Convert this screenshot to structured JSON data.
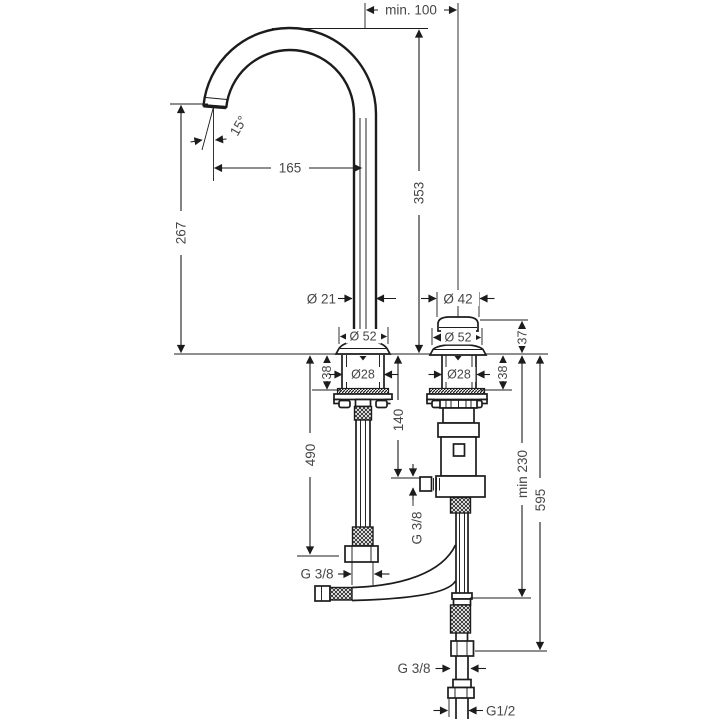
{
  "drawing": {
    "kind": "technical-installation-diagram",
    "subject": "two-hole basin mixer with gooseneck spout and below-deck valve",
    "colors": {
      "line": "#1c1c1c",
      "label": "#474747",
      "background": "#ffffff"
    },
    "labels": {
      "min_hole_distance": "min. 100",
      "spout_angle": "15°",
      "spout_reach": "165",
      "spout_outlet_height": "267",
      "spout_total_height": "353",
      "spout_tube_diameter": "Ø 21",
      "cap_diameter": "Ø 42",
      "spout_base_diameter": "Ø 52",
      "cap_base_diameter": "Ø 52",
      "cap_height": "37",
      "spout_shank_diameter": "Ø28",
      "valve_shank_diameter": "Ø28",
      "spout_shank_depth": "38",
      "valve_shank_depth": "38",
      "spout_hose_length": "490",
      "valve_outlet_depth": "140",
      "min_clearance": "min 230",
      "supply_hose_length": "595",
      "spout_hose_thread": "G 3/8",
      "valve_outlet_thread": "G 3/8",
      "supply_hose_thread": "G 3/8",
      "supply_connection_thread": "G1/2"
    }
  }
}
